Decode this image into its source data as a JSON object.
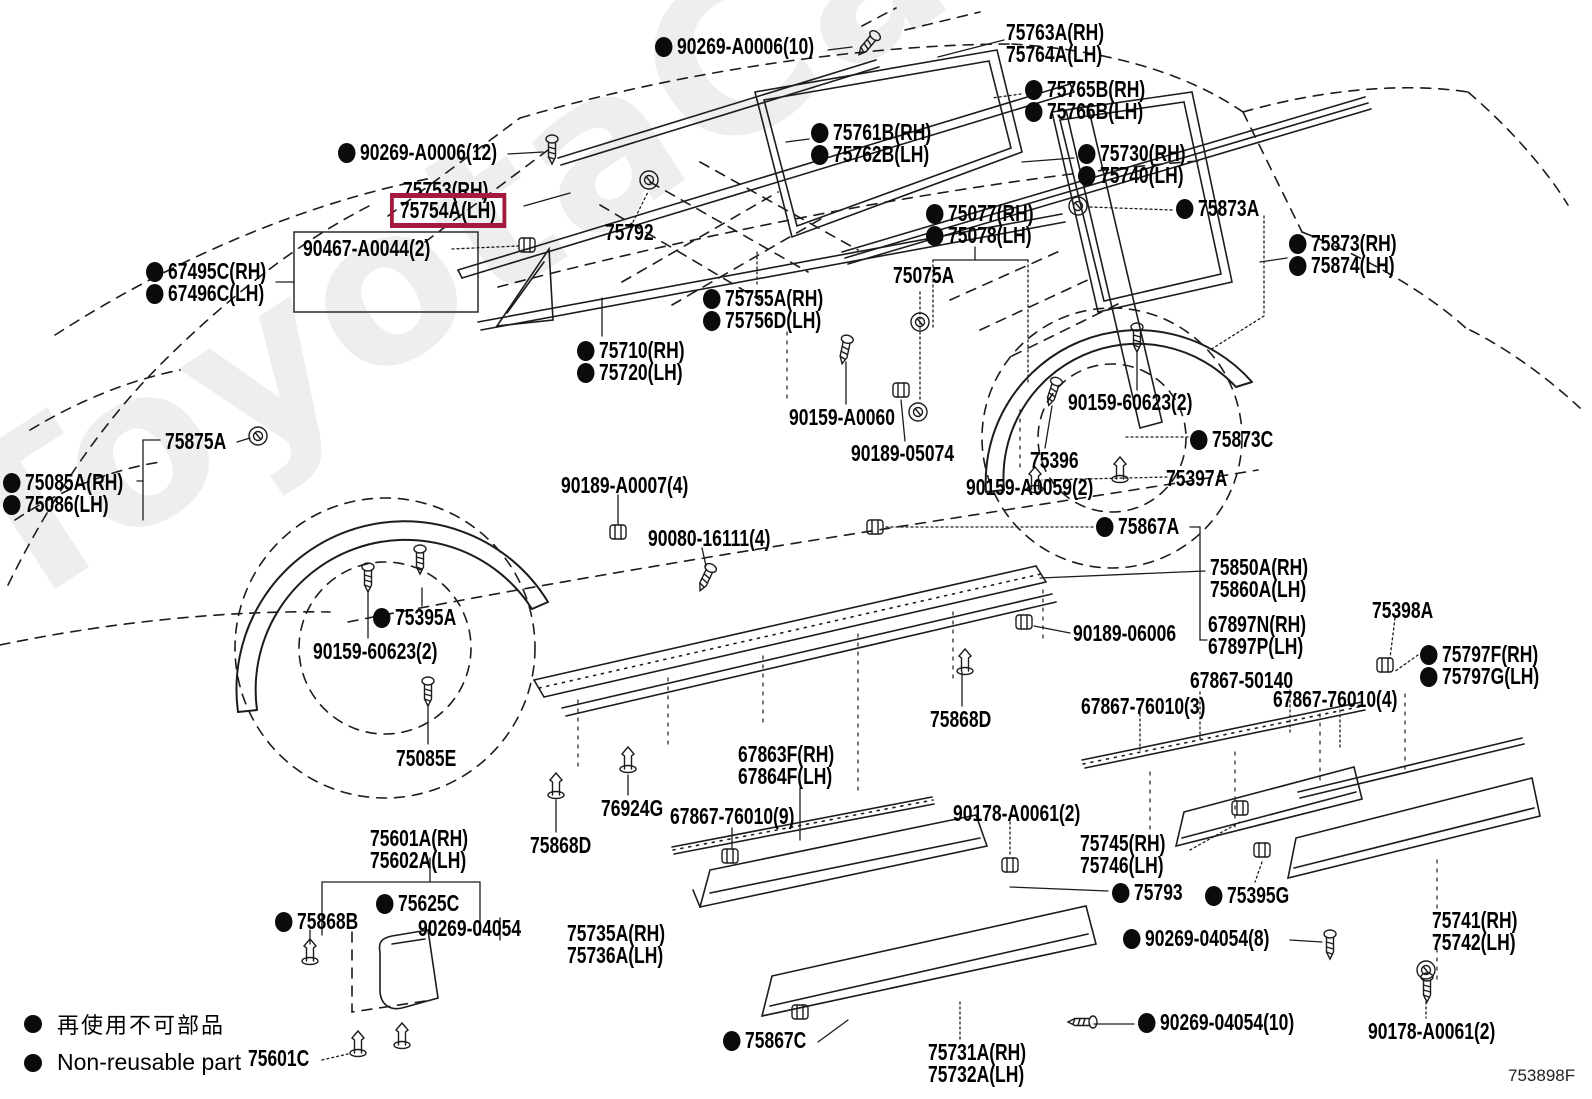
{
  "watermark": "ToyotaCarMine.ru",
  "diagram_code": "753898F",
  "highlight_color": "#A6193F",
  "legend": {
    "jp": "再使用不可部品",
    "en": "Non-reusable part"
  },
  "labels": [
    {
      "text": "90269-A0006(10)",
      "x": 655,
      "y": 36,
      "dot": true
    },
    {
      "text": "75763A(RH)",
      "x": 1006,
      "y": 22
    },
    {
      "text": "75764A(LH)",
      "x": 1006,
      "y": 44
    },
    {
      "text": "75765B(RH)",
      "x": 1025,
      "y": 79,
      "dot": true
    },
    {
      "text": "75766B(LH)",
      "x": 1025,
      "y": 101,
      "dot": true
    },
    {
      "text": "75761B(RH)",
      "x": 811,
      "y": 122,
      "dot": true
    },
    {
      "text": "75762B(LH)",
      "x": 811,
      "y": 144,
      "dot": true
    },
    {
      "text": "90269-A0006(12)",
      "x": 338,
      "y": 142,
      "dot": true
    },
    {
      "text": "75730(RH)",
      "x": 1078,
      "y": 143,
      "dot": true
    },
    {
      "text": "75740(LH)",
      "x": 1078,
      "y": 165,
      "dot": true
    },
    {
      "text": "75753(RH)",
      "x": 403,
      "y": 180
    },
    {
      "text": "75754A(LH)",
      "x": 403,
      "y": 202,
      "boxed": true
    },
    {
      "text": "75873A",
      "x": 1176,
      "y": 198,
      "dot": true
    },
    {
      "text": "75077(RH)",
      "x": 926,
      "y": 203,
      "dot": true
    },
    {
      "text": "75078(LH)",
      "x": 926,
      "y": 225,
      "dot": true
    },
    {
      "text": "75792",
      "x": 605,
      "y": 222
    },
    {
      "text": "90467-A0044(2)",
      "x": 303,
      "y": 238
    },
    {
      "text": "75873(RH)",
      "x": 1289,
      "y": 233,
      "dot": true
    },
    {
      "text": "75874(LH)",
      "x": 1289,
      "y": 255,
      "dot": true
    },
    {
      "text": "67495C(RH)",
      "x": 146,
      "y": 261,
      "dot": true
    },
    {
      "text": "67496C(LH)",
      "x": 146,
      "y": 283,
      "dot": true
    },
    {
      "text": "75075A",
      "x": 893,
      "y": 265
    },
    {
      "text": "75755A(RH)",
      "x": 703,
      "y": 288,
      "dot": true
    },
    {
      "text": "75756D(LH)",
      "x": 703,
      "y": 310,
      "dot": true
    },
    {
      "text": "75710(RH)",
      "x": 577,
      "y": 340,
      "dot": true
    },
    {
      "text": "75720(LH)",
      "x": 577,
      "y": 362,
      "dot": true
    },
    {
      "text": "90159-A0060",
      "x": 789,
      "y": 407
    },
    {
      "text": "90159-60623(2)",
      "x": 1068,
      "y": 392
    },
    {
      "text": "90189-05074",
      "x": 851,
      "y": 443
    },
    {
      "text": "75875A",
      "x": 165,
      "y": 431
    },
    {
      "text": "75396",
      "x": 1030,
      "y": 450
    },
    {
      "text": "75873C",
      "x": 1190,
      "y": 429,
      "dot": true
    },
    {
      "text": "90159-A0059(2)",
      "x": 966,
      "y": 477
    },
    {
      "text": "75397A",
      "x": 1166,
      "y": 468
    },
    {
      "text": "75085A(RH)",
      "x": 3,
      "y": 472,
      "dot": true
    },
    {
      "text": "75086(LH)",
      "x": 3,
      "y": 494,
      "dot": true
    },
    {
      "text": "90189-A0007(4)",
      "x": 561,
      "y": 475
    },
    {
      "text": "75867A",
      "x": 1096,
      "y": 516,
      "dot": true
    },
    {
      "text": "90080-16111(4)",
      "x": 648,
      "y": 528
    },
    {
      "text": "75850A(RH)",
      "x": 1210,
      "y": 557
    },
    {
      "text": "75860A(LH)",
      "x": 1210,
      "y": 579
    },
    {
      "text": "75395A",
      "x": 373,
      "y": 607,
      "dot": true
    },
    {
      "text": "90189-06006",
      "x": 1073,
      "y": 623
    },
    {
      "text": "67897N(RH)",
      "x": 1208,
      "y": 614
    },
    {
      "text": "67897P(LH)",
      "x": 1208,
      "y": 636
    },
    {
      "text": "90159-60623(2)",
      "x": 313,
      "y": 641
    },
    {
      "text": "75398A",
      "x": 1372,
      "y": 600
    },
    {
      "text": "75797F(RH)",
      "x": 1420,
      "y": 644,
      "dot": true
    },
    {
      "text": "75797G(LH)",
      "x": 1420,
      "y": 666,
      "dot": true
    },
    {
      "text": "67867-50140",
      "x": 1190,
      "y": 670
    },
    {
      "text": "67867-76010(3)",
      "x": 1081,
      "y": 696
    },
    {
      "text": "67867-76010(4)",
      "x": 1273,
      "y": 689
    },
    {
      "text": "75868D",
      "x": 930,
      "y": 709
    },
    {
      "text": "75085E",
      "x": 396,
      "y": 748
    },
    {
      "text": "67863F(RH)",
      "x": 738,
      "y": 744
    },
    {
      "text": "67864F(LH)",
      "x": 738,
      "y": 766
    },
    {
      "text": "76924G",
      "x": 601,
      "y": 798
    },
    {
      "text": "67867-76010(9)",
      "x": 670,
      "y": 806
    },
    {
      "text": "75868D",
      "x": 530,
      "y": 835
    },
    {
      "text": "90178-A0061(2)",
      "x": 953,
      "y": 803
    },
    {
      "text": "75745(RH)",
      "x": 1080,
      "y": 833
    },
    {
      "text": "75746(LH)",
      "x": 1080,
      "y": 855
    },
    {
      "text": "75601A(RH)",
      "x": 370,
      "y": 828
    },
    {
      "text": "75602A(LH)",
      "x": 370,
      "y": 850
    },
    {
      "text": "75793",
      "x": 1112,
      "y": 882,
      "dot": true
    },
    {
      "text": "75395G",
      "x": 1205,
      "y": 885,
      "dot": true
    },
    {
      "text": "75625C",
      "x": 376,
      "y": 893,
      "dot": true
    },
    {
      "text": "75868B",
      "x": 275,
      "y": 911,
      "dot": true
    },
    {
      "text": "90269-04054",
      "x": 418,
      "y": 918
    },
    {
      "text": "75735A(RH)",
      "x": 567,
      "y": 923
    },
    {
      "text": "75736A(LH)",
      "x": 567,
      "y": 945
    },
    {
      "text": "90269-04054(8)",
      "x": 1123,
      "y": 928,
      "dot": true
    },
    {
      "text": "75741(RH)",
      "x": 1432,
      "y": 910
    },
    {
      "text": "75742(LH)",
      "x": 1432,
      "y": 932
    },
    {
      "text": "90269-04054(10)",
      "x": 1138,
      "y": 1012,
      "dot": true
    },
    {
      "text": "90178-A0061(2)",
      "x": 1368,
      "y": 1021
    },
    {
      "text": "75867C",
      "x": 723,
      "y": 1030,
      "dot": true
    },
    {
      "text": "75731A(RH)",
      "x": 928,
      "y": 1042
    },
    {
      "text": "75732A(LH)",
      "x": 928,
      "y": 1064
    },
    {
      "text": "75601C",
      "x": 248,
      "y": 1048
    }
  ]
}
